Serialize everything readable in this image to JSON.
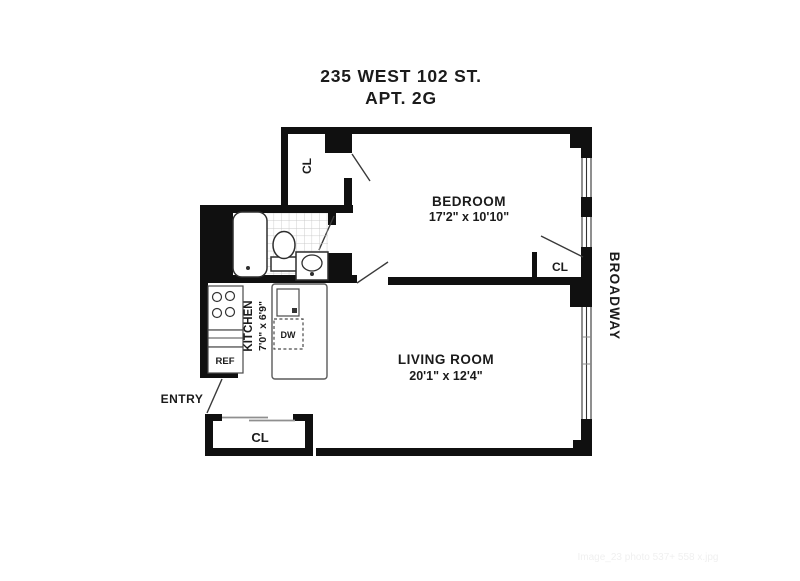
{
  "title": {
    "line1": "235 WEST 102 ST.",
    "line2": "APT. 2G"
  },
  "rooms": {
    "bedroom": {
      "name": "BEDROOM",
      "dims": "17'2\" x 10'10\""
    },
    "living_room": {
      "name": "LIVING ROOM",
      "dims": "20'1\" x 12'4\""
    },
    "kitchen": {
      "name": "KITCHEN",
      "dims": "7'0\" x 6'9\""
    }
  },
  "labels": {
    "closet_top": "CL",
    "closet_bedroom": "CL",
    "closet_entry": "CL",
    "refrigerator": "REF",
    "dishwasher": "DW",
    "entry": "ENTRY",
    "street": "BROADWAY"
  },
  "watermark": "Image_23 photo 537+ 558 x.jpg",
  "colors": {
    "wall": "#101010",
    "text": "#1b1b1b",
    "tile": "#c9c9c9",
    "watermark": "#f0f0f0"
  }
}
